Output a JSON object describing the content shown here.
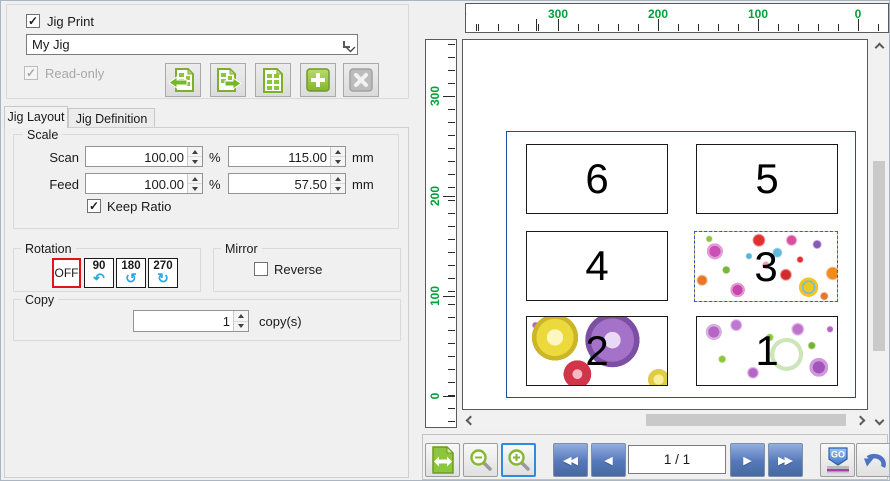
{
  "jig_panel": {
    "jig_print_label": "Jig Print",
    "jig_print_checked": true,
    "jig_selector_value": "My Jig",
    "readonly_label": "Read-only",
    "readonly_checked": true
  },
  "tabs": [
    {
      "label": "Jig Layout",
      "active": true
    },
    {
      "label": "Jig Definition",
      "active": false
    }
  ],
  "scale": {
    "label": "Scale",
    "scan": {
      "label": "Scan",
      "percent": "100.00",
      "percent_unit": "%",
      "length": "115.00",
      "length_unit": "mm"
    },
    "feed": {
      "label": "Feed",
      "percent": "100.00",
      "percent_unit": "%",
      "length": "57.50",
      "length_unit": "mm"
    },
    "keep_ratio": {
      "label": "Keep Ratio",
      "checked": true
    }
  },
  "rotation": {
    "label": "Rotation",
    "options": [
      {
        "label": "OFF",
        "selected": true
      },
      {
        "label": "90",
        "selected": false
      },
      {
        "label": "180",
        "selected": false
      },
      {
        "label": "270",
        "selected": false
      }
    ]
  },
  "mirror": {
    "label": "Mirror",
    "reverse_label": "Reverse",
    "reverse_checked": false
  },
  "copy": {
    "label": "Copy",
    "count": "1",
    "unit": "copy(s)"
  },
  "rulers": {
    "horizontal_labels": [
      "300",
      "200",
      "100",
      "0"
    ],
    "horizontal_clipped_left": "400",
    "vertical_labels": [
      "300",
      "200",
      "100",
      "0"
    ],
    "label_color": "#00a33a"
  },
  "preview": {
    "cells": [
      {
        "number": "6",
        "content": "empty"
      },
      {
        "number": "5",
        "content": "empty"
      },
      {
        "number": "4",
        "content": "empty"
      },
      {
        "number": "3",
        "content": "floral-dense",
        "selected": true
      },
      {
        "number": "2",
        "content": "floral-wreaths"
      },
      {
        "number": "1",
        "content": "floral-lilies"
      }
    ]
  },
  "navigation": {
    "page_indicator": "1 / 1",
    "go_label": "GO"
  },
  "icons": {
    "first": "◀◀",
    "prev": "◀",
    "next": "▶",
    "last": "▶▶",
    "rotate_90": "↶",
    "rotate_180": "↺",
    "rotate_270": "↻",
    "check": "✓"
  },
  "colors": {
    "accent_green": "#8cc63f",
    "nav_blue": "#5578bb",
    "zoom_selected_blue": "#2e8be0",
    "rotation_selected_red": "#e3131b",
    "jig_border_blue": "#1d4e9e",
    "ruler_label_green": "#00a33a",
    "rotate_arrow_blue": "#29abe2"
  }
}
